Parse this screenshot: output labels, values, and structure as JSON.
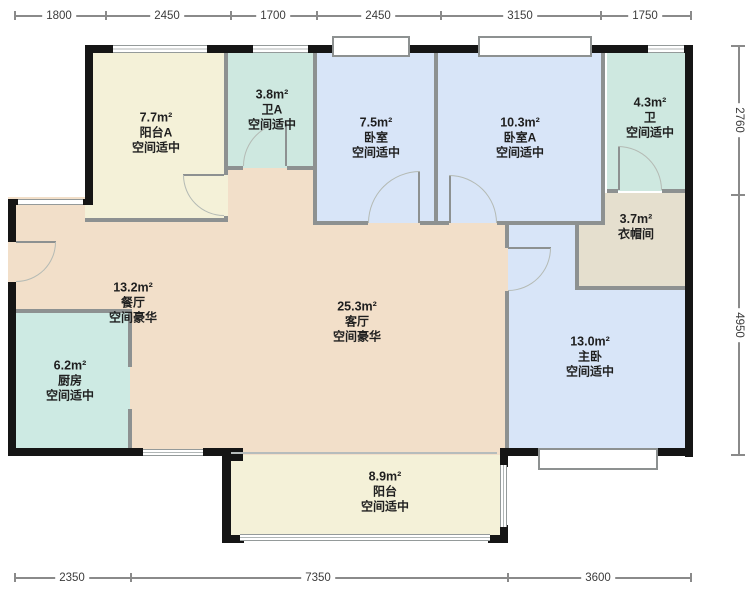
{
  "dimensions": {
    "top": [
      "1800",
      "2450",
      "1700",
      "2450",
      "3150",
      "1750"
    ],
    "bottom": [
      "2350",
      "7350",
      "3600"
    ],
    "right": [
      "2760",
      "4950"
    ]
  },
  "rooms": {
    "balcony_a": {
      "area": "7.7m²",
      "label": "阳台A",
      "grade": "空间适中"
    },
    "bath_a": {
      "area": "3.8m²",
      "label": "卫A",
      "grade": "空间适中"
    },
    "bedroom": {
      "area": "7.5m²",
      "label": "卧室",
      "grade": "空间适中"
    },
    "bedroom_a": {
      "area": "10.3m²",
      "label": "卧室A",
      "grade": "空间适中"
    },
    "bath": {
      "area": "4.3m²",
      "label": "卫",
      "grade": "空间适中"
    },
    "cloakroom": {
      "area": "3.7m²",
      "label": "衣帽间",
      "grade": ""
    },
    "dining": {
      "area": "13.2m²",
      "label": "餐厅",
      "grade": "空间豪华"
    },
    "living": {
      "area": "25.3m²",
      "label": "客厅",
      "grade": "空间豪华"
    },
    "master": {
      "area": "13.0m²",
      "label": "主卧",
      "grade": "空间适中"
    },
    "kitchen": {
      "area": "6.2m²",
      "label": "厨房",
      "grade": "空间适中"
    },
    "balcony": {
      "area": "8.9m²",
      "label": "阳台",
      "grade": "空间适中"
    }
  },
  "colors": {
    "balcony_fill": "#f4f1d8",
    "bath_fill": "#cee8e0",
    "kitchen_fill": "#cdeae3",
    "bedroom_fill": "#d8e5f8",
    "living_fill": "#f2dfc9",
    "cloakroom_fill": "#e5dfce",
    "outer_wall": "#151515",
    "inner_wall": "#8d9191",
    "background": "#ffffff"
  }
}
